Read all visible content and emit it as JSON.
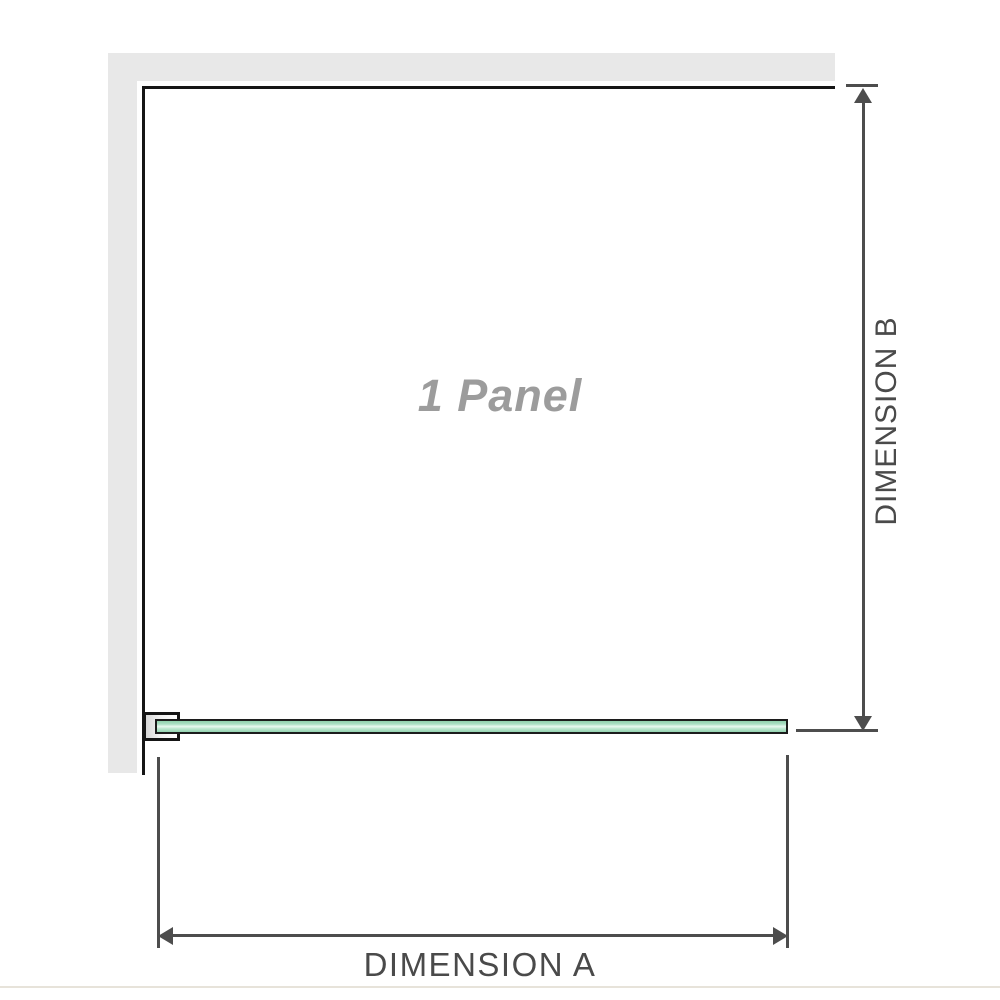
{
  "diagram": {
    "panel_label": "1 Panel",
    "dimensions": {
      "a_label": "DIMENSION A",
      "b_label": "DIMENSION B"
    }
  },
  "colors": {
    "wall": "#e8e8e8",
    "edge": "#151515",
    "glass_border": "#1c1c1c",
    "glass_green": "#abdfc4",
    "glass_highlight": "#e9f8f0",
    "dimension_line": "#4d4d4d",
    "label_text": "#4a4a4a",
    "panel_label_text": "#9c9c9c",
    "baseline": "#e7e3da"
  }
}
